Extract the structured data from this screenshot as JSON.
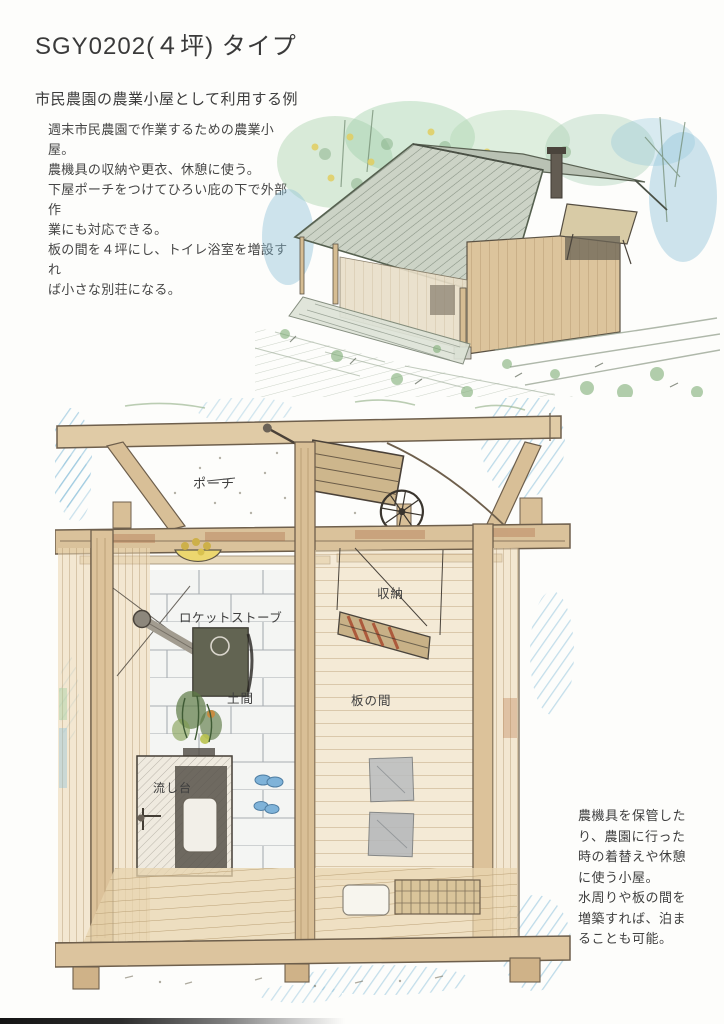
{
  "header": {
    "title": "SGY0202(４坪) タイプ",
    "subtitle": "市民農園の農業小屋として利用する例",
    "description": "週末市民農園で作業するための農業小屋。\n農機具の収納や更衣、休憩に使う。\n下屋ポーチをつけてひろい庇の下で外部作\n業にも対応できる。\n板の間を４坪にし、トイレ浴室を増設すれ\nば小さな別荘になる。"
  },
  "side_note": {
    "text": "農機具を保管した\nり、農園に行った\n時の着替えや休憩\nに使う小屋。\n水周りや板の間を\n増築すれば、泊ま\nることも可能。"
  },
  "plan_labels": {
    "porch": "ポーチ",
    "storage": "収納",
    "rocket_stove": "ロケットストーブ",
    "doma": "土間",
    "itanoma": "板の間",
    "sink": "流し台"
  },
  "colors": {
    "paper": "#fdfdfb",
    "ink": "#3d3d3d",
    "wood_tan": "#dcc29a",
    "roof_gray_green": "#c9d0c3",
    "crayon_blue": "#7db8d6",
    "foliage_green": "#9ccf9f",
    "stone_gray": "#9aa0a6"
  }
}
